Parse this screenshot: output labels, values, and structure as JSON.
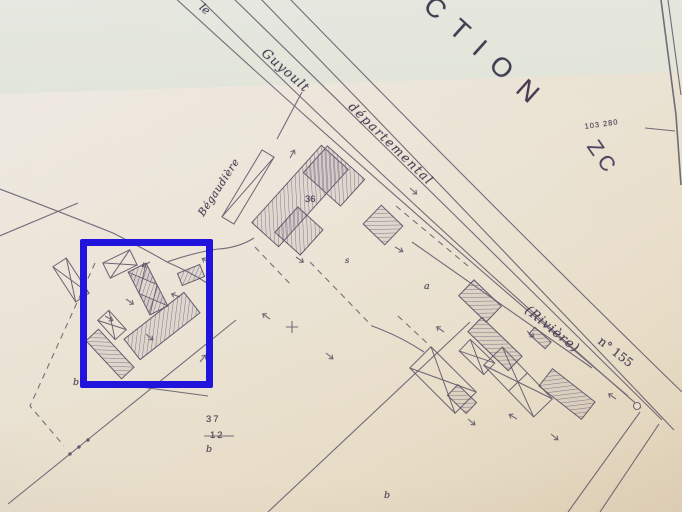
{
  "map": {
    "section_title_partial": "CTION",
    "section_code": "ZC",
    "coordinate_label": "103 280",
    "watercourse": {
      "article": "le",
      "name": "Guyoult"
    },
    "road": {
      "classification": "départemental",
      "designation": "(Rivière)",
      "number": "n° 155"
    },
    "place_name": "Bégaudière",
    "parcels": {
      "n36": "36",
      "n37": "37",
      "n12_struck": "12",
      "letter_a": "a",
      "letter_s": "s",
      "letter_b_west": "b",
      "letter_b_south": "b",
      "letter_b_southeast": "b",
      "plus_mark": "+"
    },
    "colors": {
      "highlight_blue": "#2114dc",
      "ink": "#4b4158",
      "paper": "#eae2d2",
      "paper_top_band": "#e1e5da"
    }
  }
}
